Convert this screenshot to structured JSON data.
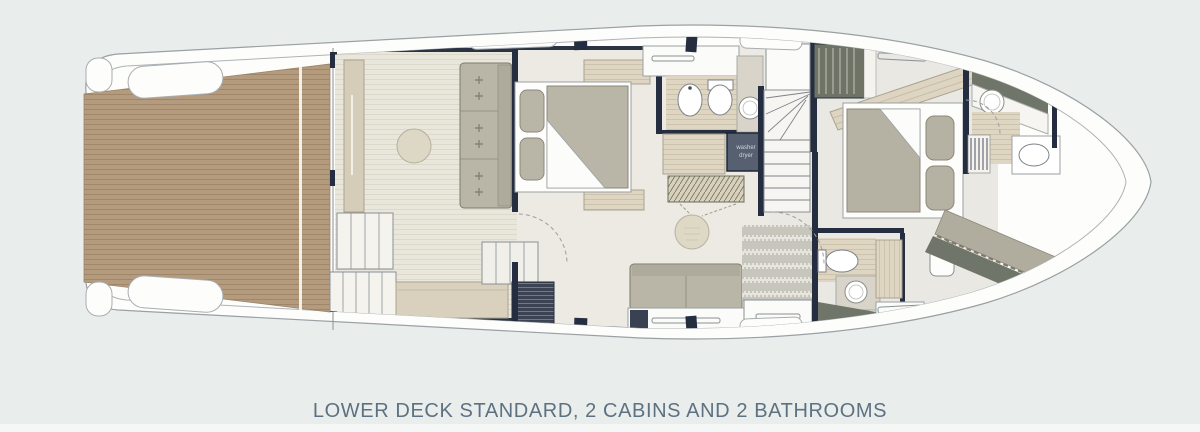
{
  "page": {
    "background_color": "#e9eeed",
    "bottom_band_color": "#f4f7f6",
    "caption": {
      "text": "LOWER DECK STANDARD, 2 CABINS AND 2 BATHROOMS",
      "color": "#5d7181"
    }
  },
  "floorplan": {
    "title": "Yacht lower deck floor plan",
    "orientation": "bow-right-stern-left",
    "colors": {
      "hull": "#fdfdfc",
      "hull_outline": "#9aa0a3",
      "walls": "#242e40",
      "teak_deck": "#b49b7e",
      "teak_plank_line": "#a0876a",
      "floor_light": "#e9e6dc",
      "floor_stripe": "#dcd8ca",
      "bath_floor": "#ded5c2",
      "furniture_upholstery": "#b9b6a7",
      "cabinet_wood": "#d9d1bd",
      "dark_fixture": "#566070",
      "dark_panel": "#6f7568"
    },
    "areas": [
      {
        "name": "swim-platform",
        "desc": "teak aft deck"
      },
      {
        "name": "salon",
        "desc": "sofa with 3 cushions, round table, sideboard, steps"
      },
      {
        "name": "midship-cabin",
        "desc": "double bed, 2 pillows, sofa, pouf, wardrobe"
      },
      {
        "name": "bathroom-1",
        "desc": "bidet, toilet, washbasin, washer dryer"
      },
      {
        "name": "staircase",
        "desc": "companionway stairs"
      },
      {
        "name": "bow-cabin",
        "desc": "double bed, 2 pillows, hanging lockers, chaise"
      },
      {
        "name": "bathroom-2",
        "desc": "toilet and round washbasin"
      },
      {
        "name": "bow-bathroom",
        "desc": "washbasin and toilet"
      }
    ],
    "labels": {
      "washer_line1": "washer",
      "washer_line2": "dryer"
    }
  }
}
